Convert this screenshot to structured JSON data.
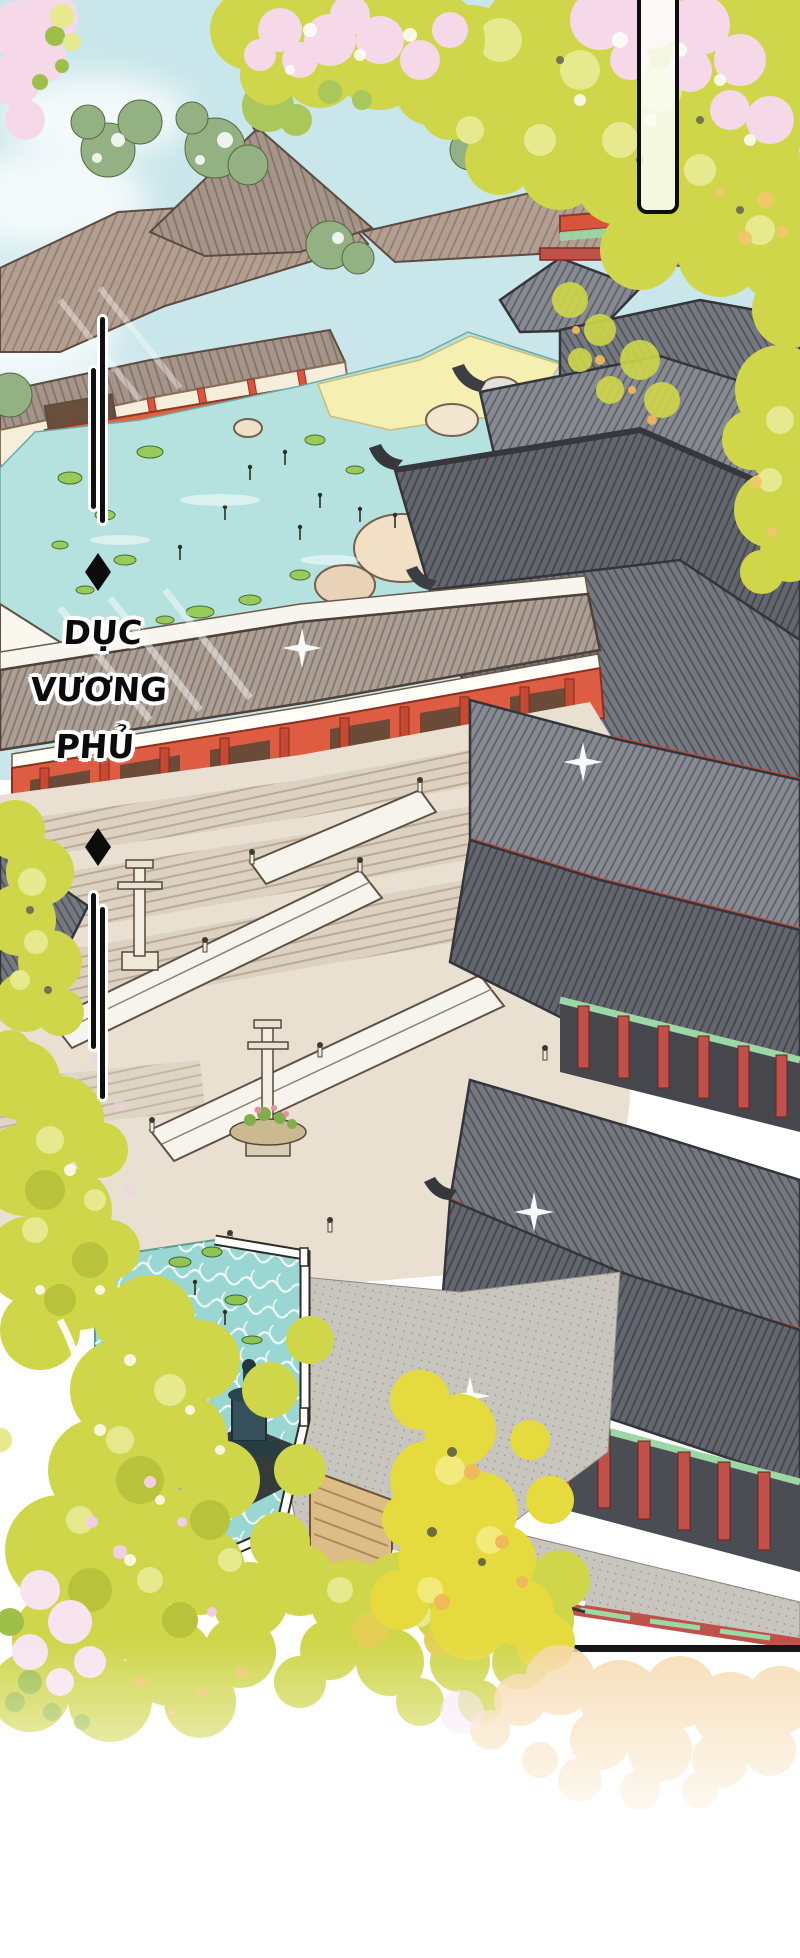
{
  "panel": {
    "alt": "Aerial manhua illustration of a sprawling palace complex with gray tiled roofs, red pillars, a lotus pond, stone courtyards, a lower pool with a bronze fountain, and golden ginkgo foliage",
    "caption": {
      "text": "DỤC VƯƠNG PHỦ",
      "lines": [
        "DỤC",
        "VƯƠNG",
        "PHỦ"
      ]
    },
    "speech_bubble": {
      "text": ""
    },
    "markers": [
      {
        "type": "diamond",
        "position": "above-caption"
      },
      {
        "type": "diamond",
        "position": "below-caption"
      }
    ]
  },
  "palette": {
    "sky": "#c9e6ea",
    "cloud": "#ffffff",
    "pond_upper": "#b5e2de",
    "pond_lower": "#9ad7d2",
    "sand_bank": "#f5f0b2",
    "roof_taupe": "#b29f92",
    "roof_corridor": "#ab9f97",
    "roof_gray": "#878a90",
    "roof_gray_mid": "#75787f",
    "roof_gray_dark": "#64666d",
    "roof_ridge": "#35373d",
    "pillar_red": "#d9543a",
    "red_dark": "#a93b2b",
    "eave_red": "#bf4a3c",
    "wall_cream": "#f6eddb",
    "wall_white": "#faf7ef",
    "accent_mint": "#9bd8a5",
    "stone_beige": "#e9e0d2",
    "stone_step": "#bcae99",
    "pavement_gray": "#c8c5bf",
    "foliage_yellow": "#cfd64a",
    "foliage_yellow_light": "#e6e98e",
    "foliage_bright": "#e5da3e",
    "foliage_gold": "#f0c96a",
    "foliage_peach": "#f6d8a8",
    "blossom_pink": "#f5d9e9",
    "tree_sage": "#93b183",
    "tree_green": "#a9c75b",
    "lilypad_green": "#97cc5a",
    "bronze_dark": "#2f4348",
    "wood_tan": "#dcbd85",
    "ink": "#101010"
  }
}
